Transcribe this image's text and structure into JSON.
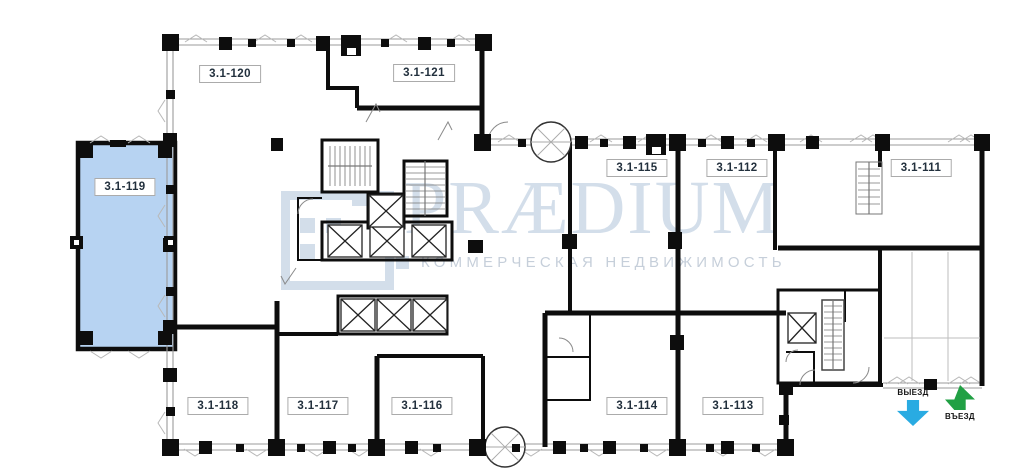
{
  "plan": {
    "highlighted_unit": "3.1-119",
    "units": [
      {
        "label": "3.1-120"
      },
      {
        "label": "3.1-121"
      },
      {
        "label": "3.1-119",
        "highlighted": true
      },
      {
        "label": "3.1-115"
      },
      {
        "label": "3.1-112"
      },
      {
        "label": "3.1-111"
      },
      {
        "label": "3.1-118"
      },
      {
        "label": "3.1-117"
      },
      {
        "label": "3.1-116"
      },
      {
        "label": "3.1-114"
      },
      {
        "label": "3.1-113"
      }
    ]
  },
  "watermark": {
    "brand": "PRÆDIUM",
    "tagline": "КОММЕРЧЕСКАЯ НЕДВИЖИМОСТЬ"
  },
  "markers": {
    "exit": "ВЫЕЗД",
    "entry": "ВЪЕЗД"
  },
  "colors": {
    "highlight_fill": "#b7d3f2",
    "exit_arrow": "#29abe2",
    "entry_arrow": "#21a044",
    "watermark_strong": "#d3deea",
    "watermark_soft": "#c6cfda",
    "label_text": "#22303d",
    "wall": "#0d0d0d",
    "window_line": "#9b9b9b"
  }
}
